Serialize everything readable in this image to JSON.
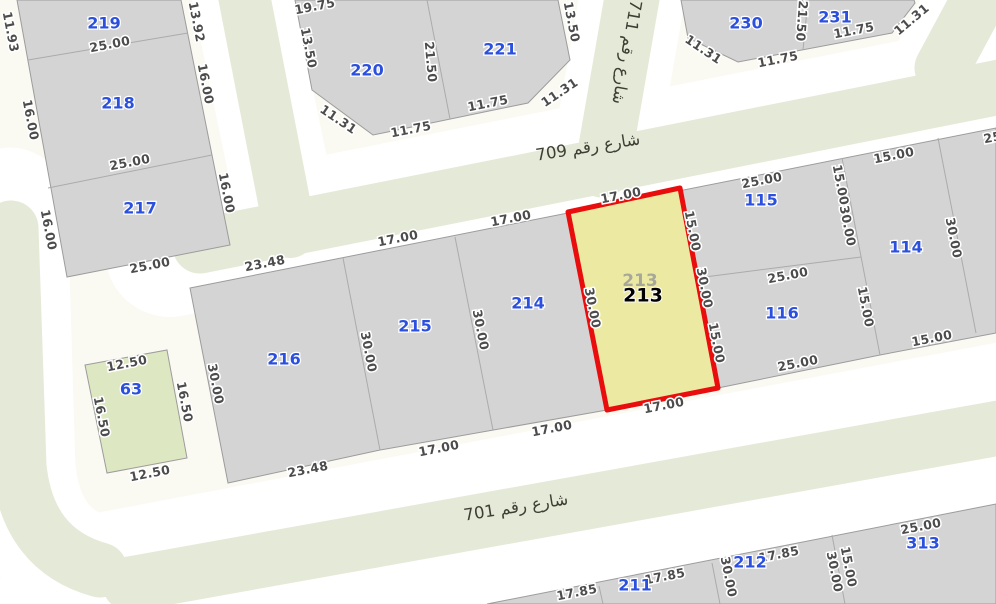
{
  "canvas": {
    "width": 996,
    "height": 604
  },
  "colors": {
    "background": "#faf9f2",
    "street_core": "#e5e9d7",
    "street_casing": "#ffffff",
    "block_fill": "#d4d4d4",
    "block_stroke": "#9c9c9c",
    "lot_line": "#ababab",
    "green_parcel_fill": "#dde7c2",
    "highlight_fill": "#eceaa2",
    "highlight_stroke": "#e90d0d",
    "parcel_number_color": "#2b50e0",
    "dimension_color": "#4c4c4c",
    "ghost_number_color": "#a8a89a",
    "selected_number_color": "#000000"
  },
  "selected_parcel": {
    "id": "213",
    "points": "568,212 680,188 718,388 607,410",
    "ghost_label": {
      "text": "213",
      "x": 640,
      "y": 281
    },
    "label": {
      "text": "213",
      "x": 643,
      "y": 296
    }
  },
  "green_parcels": [
    {
      "id": "63",
      "points": "85,365 167,350 187,458 107,473"
    }
  ],
  "blocks": [
    {
      "id": "northwest",
      "points": "17,0 181,0 230,245 67,277"
    },
    {
      "id": "north-220-221",
      "points": "295,0 312,90 373,135 528,103 570,60 558,0"
    },
    {
      "id": "northeast-230-231",
      "points": "681,0 688,38 738,62 892,33 915,3 914,0"
    },
    {
      "id": "central-strip",
      "points": "190,288 996,128 996,333 880,355 718,388 607,410 380,450 228,483"
    },
    {
      "id": "south",
      "points": "487,604 996,504 996,604"
    }
  ],
  "lot_lines": [
    {
      "x1": 28,
      "y1": 60,
      "x2": 188,
      "y2": 33
    },
    {
      "x1": 48,
      "y1": 188,
      "x2": 212,
      "y2": 155
    },
    {
      "x1": 427,
      "y1": 0,
      "x2": 450,
      "y2": 119
    },
    {
      "x1": 808,
      "y1": 0,
      "x2": 803,
      "y2": 50
    },
    {
      "x1": 343,
      "y1": 258,
      "x2": 380,
      "y2": 450
    },
    {
      "x1": 455,
      "y1": 237,
      "x2": 493,
      "y2": 430
    },
    {
      "x1": 842,
      "y1": 158,
      "x2": 880,
      "y2": 355
    },
    {
      "x1": 938,
      "y1": 138,
      "x2": 976,
      "y2": 333
    },
    {
      "x1": 697,
      "y1": 278,
      "x2": 861,
      "y2": 257
    },
    {
      "x1": 599,
      "y1": 586,
      "x2": 603,
      "y2": 604
    },
    {
      "x1": 712,
      "y1": 563,
      "x2": 720,
      "y2": 604
    },
    {
      "x1": 832,
      "y1": 535,
      "x2": 845,
      "y2": 604
    }
  ],
  "streets": [
    {
      "id": "709",
      "name": "شارع رقم 709",
      "casing_d": "M 170,252 L 1010,85",
      "casing_w": 130,
      "core_d": "M 200,246 L 1010,85",
      "core_w": 55,
      "label": {
        "x": 588,
        "y": 148,
        "rot": -9
      }
    },
    {
      "id": "711",
      "name": "شارع رقم 711",
      "casing_d": "M 636,-25 L 603,165",
      "casing_w": 105,
      "core_d": "M 636,-25 L 602,170",
      "core_w": 55,
      "label": {
        "x": 626,
        "y": 52,
        "rot": 100
      }
    },
    {
      "id": "701",
      "name": "شارع رقم 701",
      "casing_d": "M 80,600 L 1010,424",
      "casing_w": 165,
      "core_d": "M 130,584 L 1010,426",
      "core_w": 55,
      "label": {
        "x": 516,
        "y": 508,
        "rot": -9
      }
    },
    {
      "id": "west",
      "name": null,
      "casing_d": "M 10,205 L 18,468 Q 26,556 100,574",
      "casing_w": 115,
      "core_d": "M 11,228 L 19,466 Q 27,550 100,570",
      "core_w": 55,
      "label": null
    },
    {
      "id": "north",
      "name": null,
      "casing_d": "M 238,-25 L 292,235",
      "casing_w": 100,
      "core_d": "M 240,-25 L 290,232",
      "core_w": 52,
      "label": null
    },
    {
      "id": "northeast",
      "name": null,
      "casing_d": "M 936,72 L 988,-28",
      "casing_w": 95,
      "core_d": "M 942,68 L 992,-25",
      "core_w": 55,
      "label": null
    }
  ],
  "parcel_numbers": [
    {
      "id": "219",
      "x": 104,
      "y": 24
    },
    {
      "id": "218",
      "x": 118,
      "y": 104
    },
    {
      "id": "217",
      "x": 140,
      "y": 209
    },
    {
      "id": "220",
      "x": 367,
      "y": 71
    },
    {
      "id": "221",
      "x": 500,
      "y": 50
    },
    {
      "id": "230",
      "x": 746,
      "y": 24
    },
    {
      "id": "231",
      "x": 835,
      "y": 18
    },
    {
      "id": "216",
      "x": 284,
      "y": 360
    },
    {
      "id": "215",
      "x": 415,
      "y": 327
    },
    {
      "id": "214",
      "x": 528,
      "y": 304
    },
    {
      "id": "115",
      "x": 761,
      "y": 201
    },
    {
      "id": "116",
      "x": 782,
      "y": 314
    },
    {
      "id": "114",
      "x": 906,
      "y": 248
    },
    {
      "id": "63",
      "x": 131,
      "y": 390
    },
    {
      "id": "211",
      "x": 635,
      "y": 586
    },
    {
      "id": "212",
      "x": 750,
      "y": 563
    },
    {
      "id": "313",
      "x": 923,
      "y": 544
    }
  ],
  "dimensions": [
    {
      "t": "11.93",
      "x": 10,
      "y": 32,
      "r": 79
    },
    {
      "t": "25.00",
      "x": 110,
      "y": 45,
      "r": -11
    },
    {
      "t": "13.92",
      "x": 196,
      "y": 22,
      "r": 79
    },
    {
      "t": "16.00",
      "x": 30,
      "y": 120,
      "r": 79
    },
    {
      "t": "16.00",
      "x": 205,
      "y": 84,
      "r": 79
    },
    {
      "t": "25.00",
      "x": 130,
      "y": 163,
      "r": -11
    },
    {
      "t": "16.00",
      "x": 48,
      "y": 230,
      "r": 79
    },
    {
      "t": "16.00",
      "x": 226,
      "y": 193,
      "r": 79
    },
    {
      "t": "25.00",
      "x": 150,
      "y": 266,
      "r": -11
    },
    {
      "t": "19.75",
      "x": 315,
      "y": 7,
      "r": -11
    },
    {
      "t": "13.50",
      "x": 308,
      "y": 48,
      "r": 79
    },
    {
      "t": "11.31",
      "x": 338,
      "y": 120,
      "r": 34
    },
    {
      "t": "11.75",
      "x": 411,
      "y": 130,
      "r": -11
    },
    {
      "t": "21.50",
      "x": 430,
      "y": 62,
      "r": 85
    },
    {
      "t": "11.75",
      "x": 488,
      "y": 104,
      "r": -11
    },
    {
      "t": "11.31",
      "x": 560,
      "y": 93,
      "r": -34
    },
    {
      "t": "13.50",
      "x": 571,
      "y": 22,
      "r": 79
    },
    {
      "t": "11.31",
      "x": 703,
      "y": 50,
      "r": 34
    },
    {
      "t": "11.75",
      "x": 778,
      "y": 60,
      "r": -11
    },
    {
      "t": "21.50",
      "x": 801,
      "y": 21,
      "r": 94
    },
    {
      "t": "11.75",
      "x": 854,
      "y": 31,
      "r": -11
    },
    {
      "t": "11.31",
      "x": 912,
      "y": 20,
      "r": -40
    },
    {
      "t": "23.48",
      "x": 265,
      "y": 264,
      "r": -11
    },
    {
      "t": "17.00",
      "x": 398,
      "y": 239,
      "r": -11
    },
    {
      "t": "17.00",
      "x": 511,
      "y": 219,
      "r": -11
    },
    {
      "t": "17.00",
      "x": 621,
      "y": 196,
      "r": -11
    },
    {
      "t": "25.00",
      "x": 762,
      "y": 181,
      "r": -11
    },
    {
      "t": "15.00",
      "x": 894,
      "y": 156,
      "r": -11
    },
    {
      "t": "25.00",
      "x": 1004,
      "y": 136,
      "r": -11
    },
    {
      "t": "30.00",
      "x": 215,
      "y": 384,
      "r": 79
    },
    {
      "t": "30.00",
      "x": 368,
      "y": 352,
      "r": 79
    },
    {
      "t": "30.00",
      "x": 480,
      "y": 330,
      "r": 79
    },
    {
      "t": "30.00",
      "x": 592,
      "y": 308,
      "r": 79
    },
    {
      "t": "15.00",
      "x": 692,
      "y": 231,
      "r": 79
    },
    {
      "t": "30.00",
      "x": 704,
      "y": 288,
      "r": 79
    },
    {
      "t": "15.00",
      "x": 716,
      "y": 343,
      "r": 79
    },
    {
      "t": "25.00",
      "x": 788,
      "y": 276,
      "r": -11
    },
    {
      "t": "15.00",
      "x": 840,
      "y": 185,
      "r": 79
    },
    {
      "t": "30.00",
      "x": 847,
      "y": 226,
      "r": 79
    },
    {
      "t": "15.00",
      "x": 865,
      "y": 307,
      "r": 79
    },
    {
      "t": "30.00",
      "x": 953,
      "y": 238,
      "r": 79
    },
    {
      "t": "23.48",
      "x": 308,
      "y": 470,
      "r": -11
    },
    {
      "t": "17.00",
      "x": 439,
      "y": 449,
      "r": -11
    },
    {
      "t": "17.00",
      "x": 552,
      "y": 429,
      "r": -11
    },
    {
      "t": "17.00",
      "x": 664,
      "y": 406,
      "r": -11
    },
    {
      "t": "25.00",
      "x": 798,
      "y": 364,
      "r": -11
    },
    {
      "t": "15.00",
      "x": 932,
      "y": 339,
      "r": -11
    },
    {
      "t": "12.50",
      "x": 127,
      "y": 364,
      "r": -11
    },
    {
      "t": "16.50",
      "x": 101,
      "y": 417,
      "r": 79
    },
    {
      "t": "16.50",
      "x": 184,
      "y": 402,
      "r": 79
    },
    {
      "t": "12.50",
      "x": 150,
      "y": 474,
      "r": -11
    },
    {
      "t": "17.85",
      "x": 577,
      "y": 593,
      "r": -11
    },
    {
      "t": "17.85",
      "x": 665,
      "y": 577,
      "r": -11
    },
    {
      "t": "30.00",
      "x": 728,
      "y": 577,
      "r": 79
    },
    {
      "t": "17.85",
      "x": 779,
      "y": 555,
      "r": -11
    },
    {
      "t": "30.00",
      "x": 834,
      "y": 572,
      "r": 79
    },
    {
      "t": "15.00",
      "x": 848,
      "y": 567,
      "r": 79
    },
    {
      "t": "25.00",
      "x": 921,
      "y": 527,
      "r": -11
    }
  ]
}
